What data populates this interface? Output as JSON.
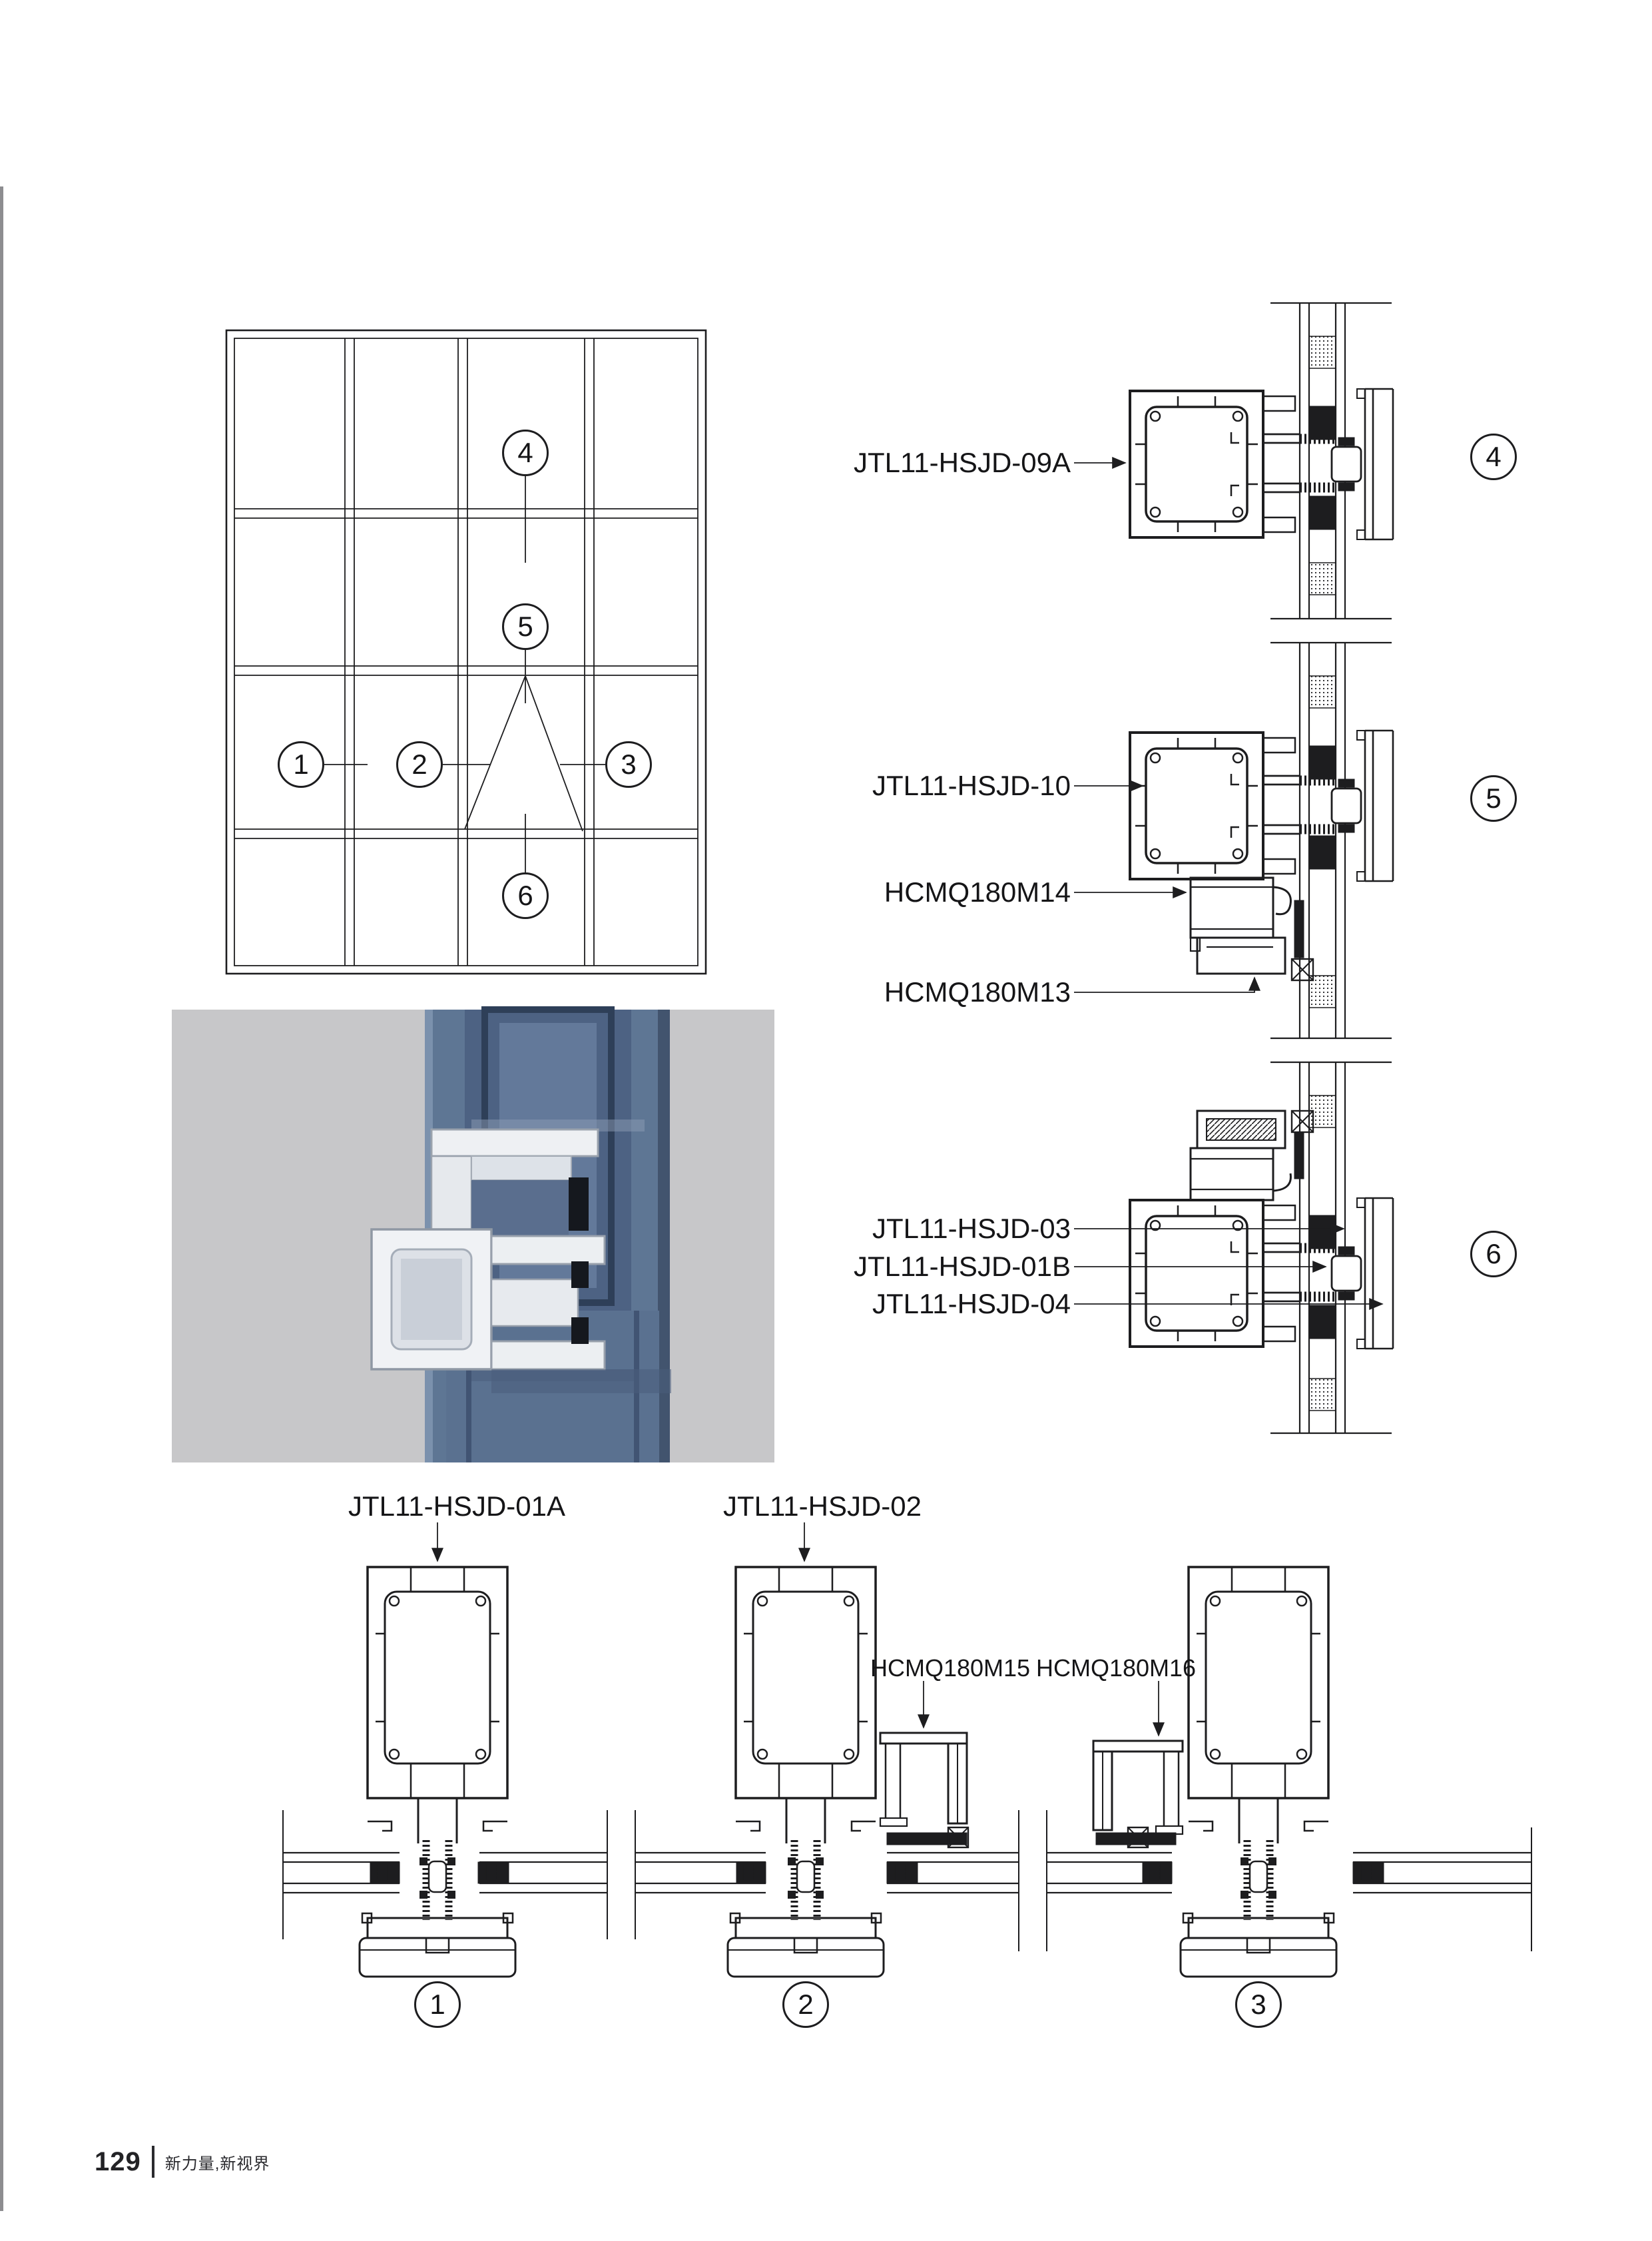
{
  "footer": {
    "page_number": "129",
    "tagline": "新力量,新视界"
  },
  "elevation": {
    "callouts": {
      "1": "1",
      "2": "2",
      "3": "3",
      "4": "4",
      "5": "5",
      "6": "6"
    }
  },
  "details": {
    "callout_4": "4",
    "callout_5": "5",
    "callout_6": "6",
    "label_09a": "JTL11-HSJD-09A",
    "label_10": "JTL11-HSJD-10",
    "label_m14": "HCMQ180M14",
    "label_m13": "HCMQ180M13",
    "label_03": "JTL11-HSJD-03",
    "label_01b": "JTL11-HSJD-01B",
    "label_04": "JTL11-HSJD-04"
  },
  "bottom_details": {
    "callout_1": "1",
    "callout_2": "2",
    "callout_3": "3",
    "label_01a": "JTL11-HSJD-01A",
    "label_02": "JTL11-HSJD-02",
    "label_m15": "HCMQ180M15",
    "label_m16": "HCMQ180M16"
  },
  "colors": {
    "line": "#1d1d1f",
    "page": "#ffffff",
    "spine": "#8d8d90",
    "photo_background": "#c7c7c9",
    "photo_column_blue": "#5e7694",
    "photo_profile_white": "#f0f2f5",
    "photo_gasket_black": "#15181e"
  }
}
